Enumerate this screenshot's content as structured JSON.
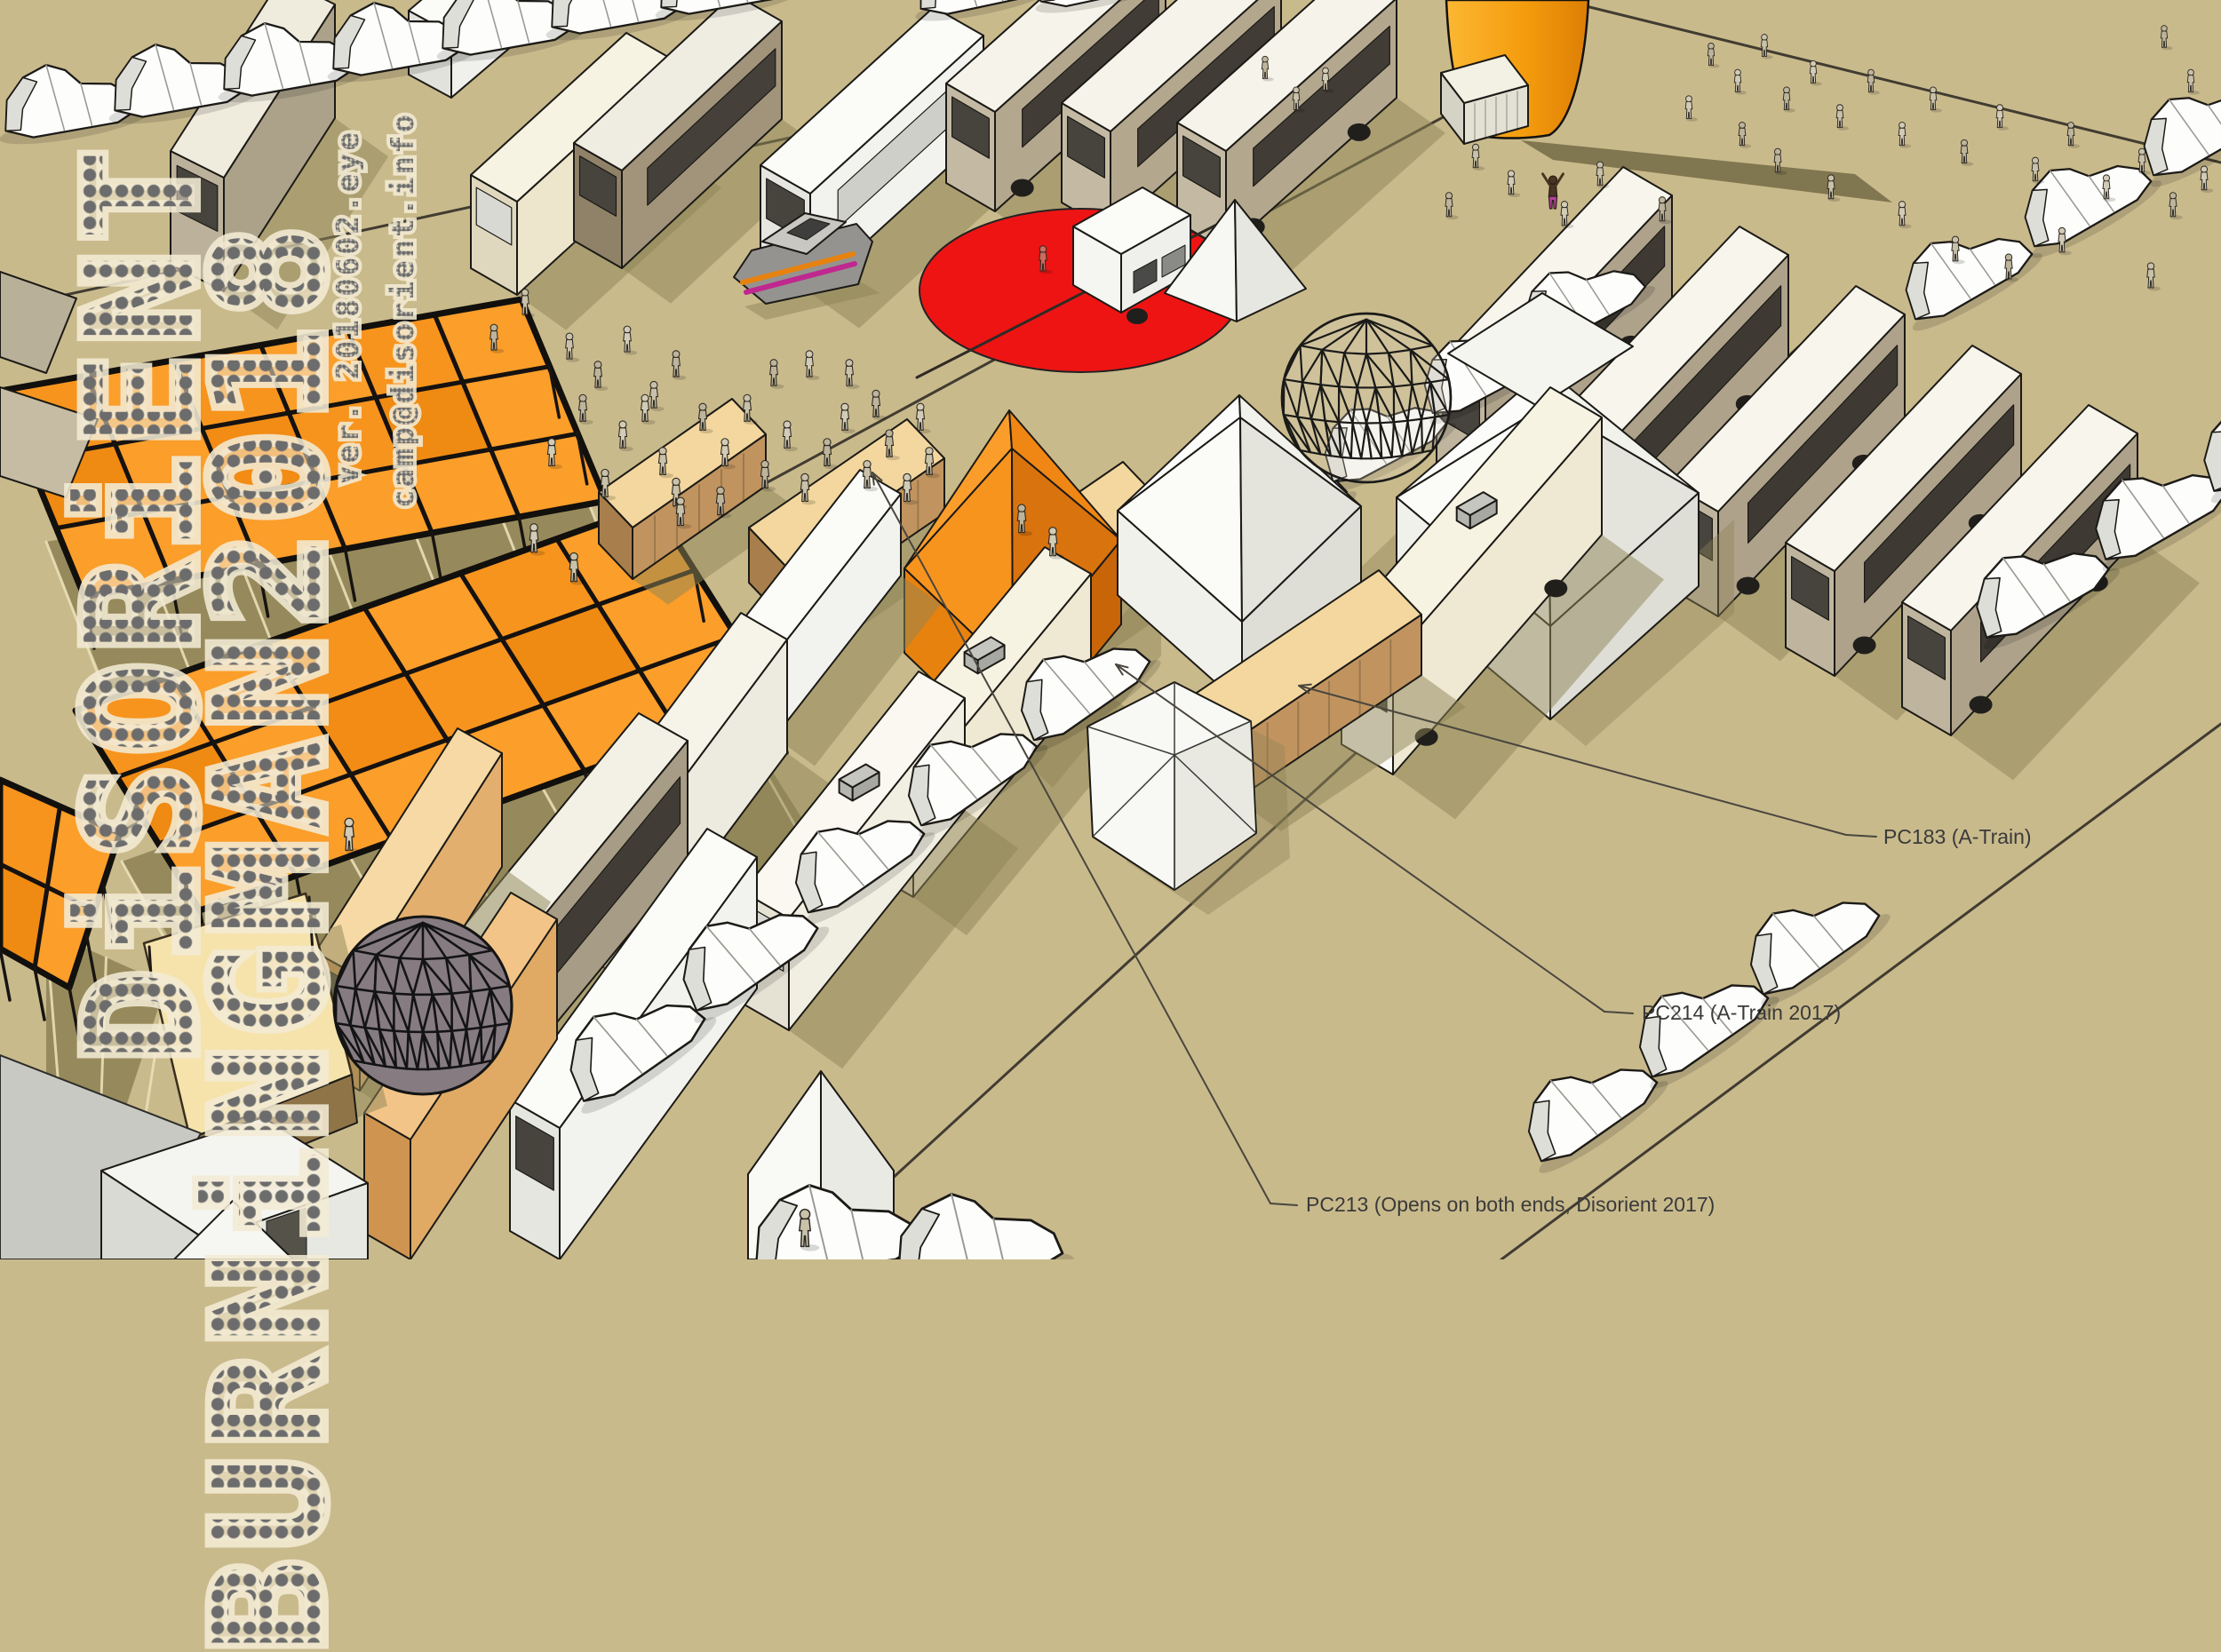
{
  "logo": {
    "title_vertical": "DiSORiENT",
    "subtitle_vertical": "BURNiNGMAN2018",
    "version_vertical": "ver. 20180602.eye",
    "contact_vertical": "camp@disorient.info"
  },
  "callouts": {
    "pc183": "PC183 (A-Train)",
    "pc214": "PC214 (A-Train 2017)",
    "pc213": "PC213 (Opens on both ends, Disorient 2017)"
  },
  "colors": {
    "ground": "#C9BA8C",
    "canopy_orange": "#F7941E",
    "sound_zone_red": "#EE1414",
    "tower_orange": "#F49C0D",
    "container_tan": "#E9C88F",
    "logo_gray": "#6C6C6C",
    "logo_halo": "#F0E8D0",
    "label_text": "#3A3A3A"
  }
}
